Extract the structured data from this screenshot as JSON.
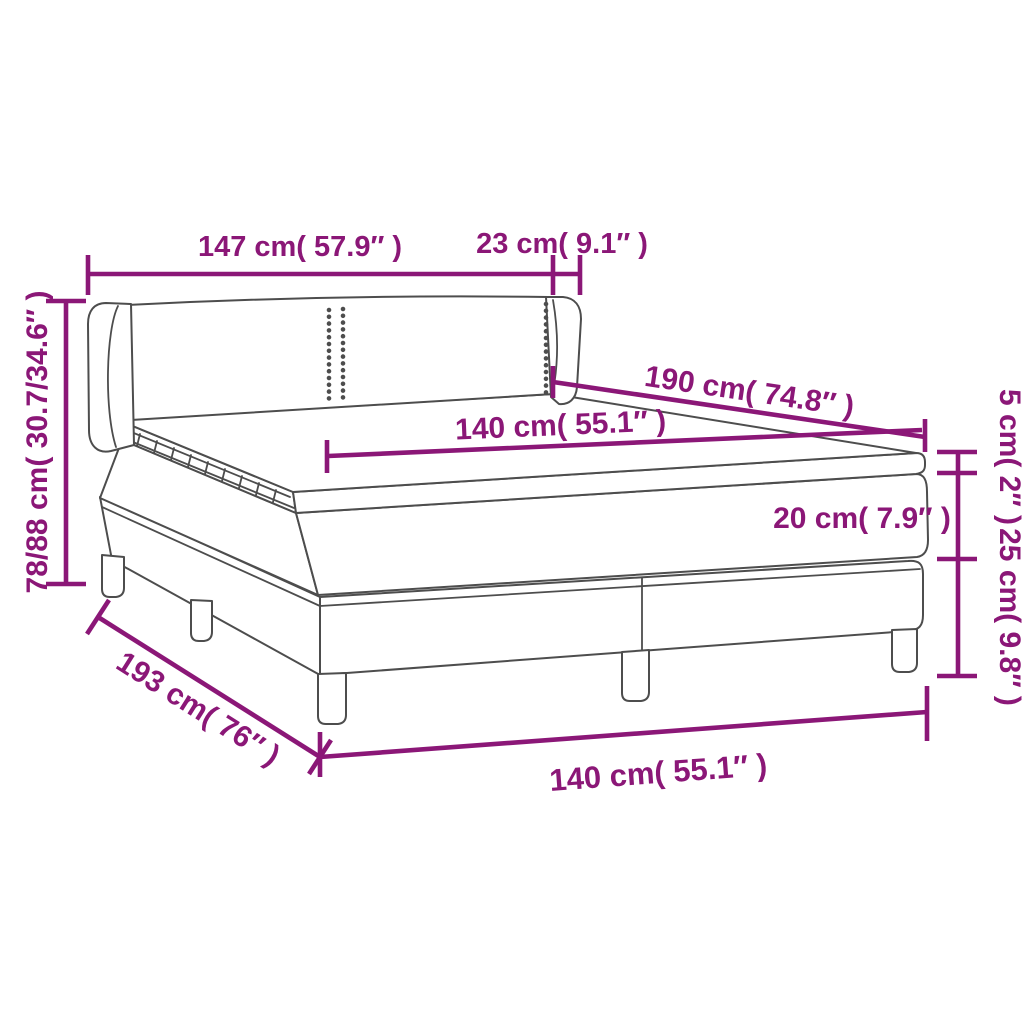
{
  "diagram": {
    "type": "product-dimension-diagram",
    "subject": "box spring bed with winged headboard, two-piece base, mattress and topper",
    "colors": {
      "accent": "#8b1777",
      "line_art": "#4d4d4d",
      "background": "#ffffff"
    },
    "dimensions": {
      "headboard_width": "147 cm( 57.9″ )",
      "wing_depth": "23 cm( 9.1″ )",
      "total_height": "78/88 cm( 30.7/34.6″ )",
      "bed_length": "190 cm( 74.8″ )",
      "mattress_width": "140 cm( 55.1″ )",
      "topper_height": "5 cm( 2″ )",
      "mattress_height": "20 cm( 7.9″ )",
      "base_height": "25 cm( 9.8″ )",
      "total_length": "193 cm( 76″ )",
      "base_width": "140 cm( 55.1″ )"
    }
  }
}
